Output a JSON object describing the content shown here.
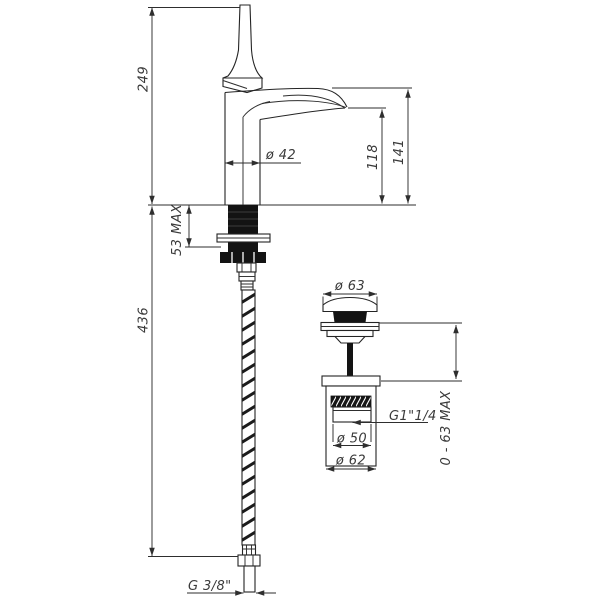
{
  "document": {
    "subject": "technical dimension drawing of a single-lever basin mixer tap with flexible supply hose and pop-up waste",
    "background": "#ffffff",
    "line_color": "#2e2e2e",
    "text_color": "#3a3a3a"
  },
  "labels": {
    "spout_total_height": "249",
    "hose_length": "436",
    "deck_thickness_max": "53 MAX",
    "body_diameter": "ø 42",
    "spout_outlet_height": "118",
    "spout_top_height": "141",
    "supply_thread": "G 3/8\"",
    "waste_cap_diameter": "ø 63",
    "waste_thread": "G1\"1/4",
    "waste_inner_diameter": "ø 50",
    "waste_body_diameter": "ø 62",
    "waste_clamp_range": "0 - 63 MAX"
  }
}
